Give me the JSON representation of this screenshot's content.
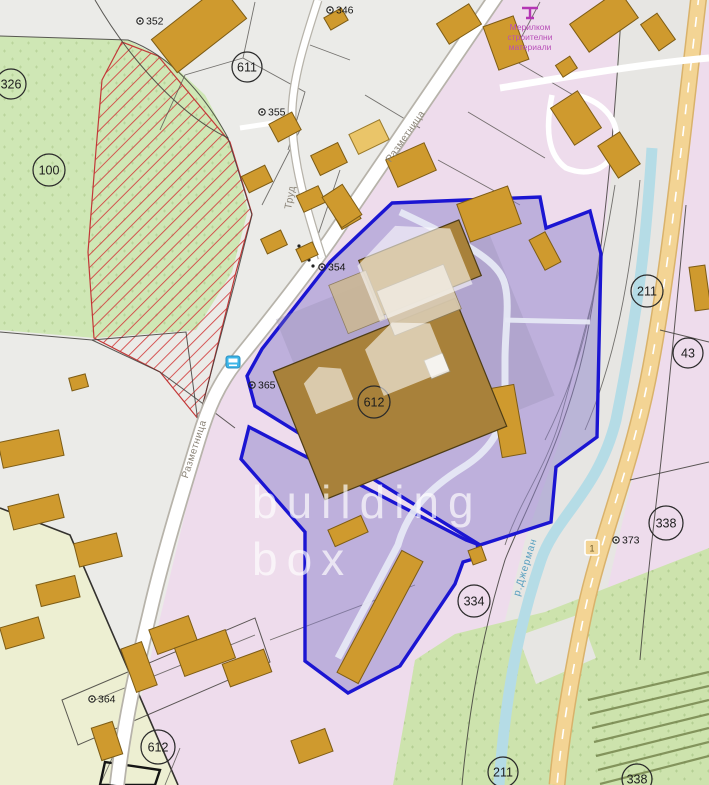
{
  "map": {
    "watermark": {
      "brand_line1": "building",
      "brand_line2": "box"
    },
    "selected_parcel": {
      "number": "612"
    },
    "streets": [
      {
        "name": "Разметница"
      },
      {
        "name": "Разметница"
      },
      {
        "name": "Труд"
      }
    ],
    "river": {
      "name": "р.Джерман"
    },
    "road_shield": {
      "number": "1"
    },
    "poi": {
      "line1": "Мерилком",
      "line2": "строителни",
      "line3": "материали"
    },
    "icons": {
      "bus_stop": "bus-stop-icon",
      "poi_marker": "shop-marker-icon"
    },
    "parcel_circles": [
      {
        "number": "326"
      },
      {
        "number": "100"
      },
      {
        "number": "611"
      },
      {
        "number": "211"
      },
      {
        "number": "43"
      },
      {
        "number": "338"
      },
      {
        "number": "334"
      },
      {
        "number": "612"
      },
      {
        "number": "211"
      },
      {
        "number": "338"
      },
      {
        "number": "612"
      }
    ],
    "point_markers": [
      {
        "number": "346"
      },
      {
        "number": "352"
      },
      {
        "number": "355"
      },
      {
        "number": "354"
      },
      {
        "number": "365"
      },
      {
        "number": "364"
      },
      {
        "number": "373"
      }
    ],
    "colors": {
      "background": "#ebebe8",
      "parcel_pink": "#eedcec",
      "greenery": "#cfe7b5",
      "building_gold": "#cf9a2e",
      "building_brown": "#a8813a",
      "road_tan": "#f3d494",
      "water_blue": "#b5dce6",
      "hatch_red": "#d23c3c",
      "selection_blue": "#1b15d2"
    }
  }
}
